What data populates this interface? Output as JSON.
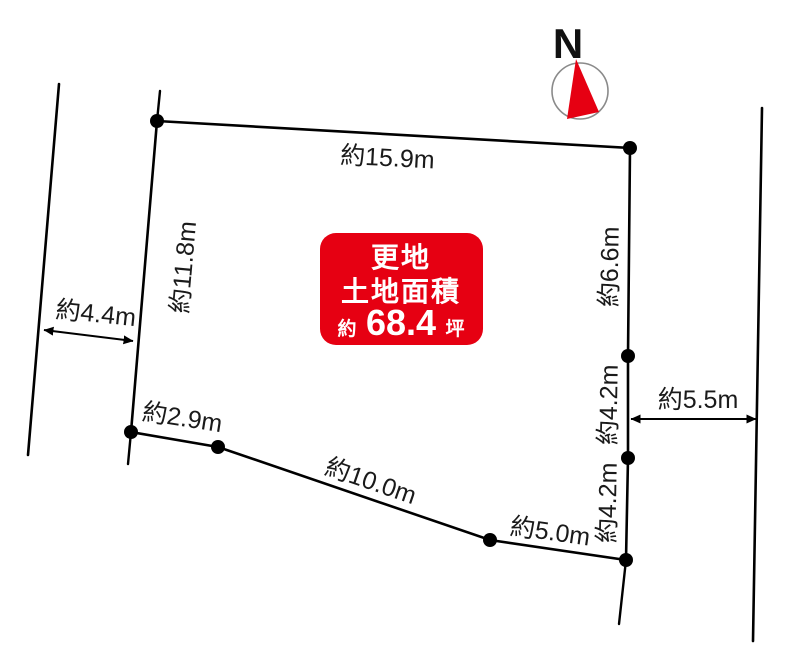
{
  "diagram": {
    "compass": {
      "north_label": "N"
    },
    "area_badge": {
      "line1": "更地",
      "line2": "土地面積",
      "value_prefix": "約",
      "value": "68.4",
      "value_unit": "坪"
    },
    "dimensions": {
      "top_edge": "約15.9m",
      "left_edge": "約11.8m",
      "right_upper_edge": "約6.6m",
      "right_middle_edge": "約4.2m",
      "right_lower_edge": "約4.2m",
      "bottom_left_edge": "約2.9m",
      "bottom_edge": "約10.0m",
      "bottom_right_edge": "約5.0m",
      "left_road_width": "約4.4m",
      "right_road_width": "約5.5m"
    },
    "colors": {
      "parcel_fill": "#d9f3d6",
      "parcel_stroke": "#000000",
      "badge_background": "#e60012",
      "badge_text": "#ffffff",
      "compass_needle": "#e60012",
      "compass_ring": "#8a8a8a",
      "line_color": "#000000",
      "background": "#ffffff"
    }
  }
}
